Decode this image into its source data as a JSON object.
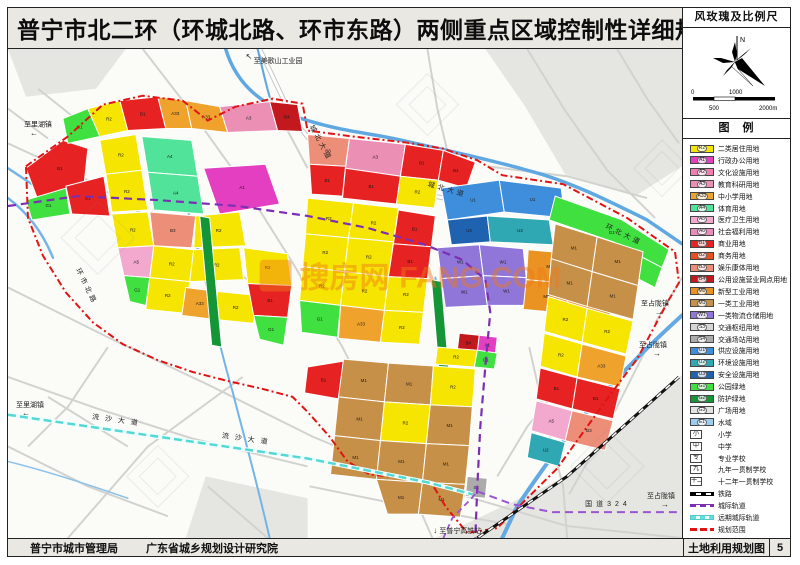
{
  "title": "普宁市北二环（环城北路、环市东路）两侧重点区域控制性详细规划",
  "sidebar": {
    "windrose_title": "风玫瑰及比例尺",
    "north_label": "N",
    "scale": {
      "s0": "0",
      "s500": "500",
      "s1000": "1000",
      "s2000": "2000m"
    },
    "legend_title": "图　例"
  },
  "footer": {
    "agency1": "普宁市城市管理局",
    "agency2": "广东省城乡规划设计研究院",
    "sheet_name": "土地利用规划图",
    "page": "5"
  },
  "watermark": {
    "cn": "搜房网",
    "en": "FANG.COM"
  },
  "legend": {
    "items": [
      {
        "type": "area",
        "code": "R2",
        "label": "二类居住用地",
        "color": "#F5E500"
      },
      {
        "type": "area",
        "code": "A1",
        "label": "行政办公用地",
        "color": "#E33FC0"
      },
      {
        "type": "area",
        "code": "A2",
        "label": "文化设施用地",
        "color": "#F07EB0"
      },
      {
        "type": "area",
        "code": "A3",
        "label": "教育科研用地",
        "color": "#EC8FB4"
      },
      {
        "type": "area",
        "code": "A33",
        "label": "中小学用地",
        "color": "#F0A32C"
      },
      {
        "type": "area",
        "code": "A4",
        "label": "体育用地",
        "color": "#52E39A"
      },
      {
        "type": "area",
        "code": "A5",
        "label": "医疗卫生用地",
        "color": "#F3A8CE"
      },
      {
        "type": "area",
        "code": "A6",
        "label": "社会福利用地",
        "color": "#E98BBB"
      },
      {
        "type": "area",
        "code": "B1",
        "label": "商业用地",
        "color": "#E62222"
      },
      {
        "type": "area",
        "code": "B2",
        "label": "商务用地",
        "color": "#E8501E"
      },
      {
        "type": "area",
        "code": "B3",
        "label": "娱乐康体用地",
        "color": "#EC8E78"
      },
      {
        "type": "area",
        "code": "B4",
        "label": "公用设施营业网点用地",
        "color": "#C2181E"
      },
      {
        "type": "area",
        "code": "M0",
        "label": "新型工业用地",
        "color": "#EA9222"
      },
      {
        "type": "area",
        "code": "M1",
        "label": "一类工业用地",
        "color": "#C79048"
      },
      {
        "type": "area",
        "code": "W1",
        "label": "一类物流仓储用地",
        "color": "#8F76D8"
      },
      {
        "type": "area",
        "code": "S3",
        "label": "交通枢纽用地",
        "color": "#D6D6D6"
      },
      {
        "type": "area",
        "code": "S4",
        "label": "交通场站用地",
        "color": "#ABABAB"
      },
      {
        "type": "area",
        "code": "U1",
        "label": "供应设施用地",
        "color": "#3E8EDC"
      },
      {
        "type": "area",
        "code": "U2",
        "label": "环境设施用地",
        "color": "#2FA8B4"
      },
      {
        "type": "area",
        "code": "U3",
        "label": "安全设施用地",
        "color": "#1F63B0"
      },
      {
        "type": "area",
        "code": "G1",
        "label": "公园绿地",
        "color": "#3FE03F"
      },
      {
        "type": "area",
        "code": "G2",
        "label": "防护绿地",
        "color": "#149637"
      },
      {
        "type": "area",
        "code": "G3",
        "label": "广场用地",
        "color": "#E3E3E3"
      },
      {
        "type": "area",
        "code": "E1",
        "label": "水域",
        "color": "#9CCCF0"
      },
      {
        "type": "symbol",
        "glyph": "小",
        "label": "小学"
      },
      {
        "type": "symbol",
        "glyph": "中",
        "label": "中学"
      },
      {
        "type": "symbol",
        "glyph": "专",
        "label": "专业学校"
      },
      {
        "type": "symbol",
        "glyph": "九",
        "label": "九年一贯制学校"
      },
      {
        "type": "symbol",
        "glyph": "十二",
        "label": "十二年一贯制学校"
      },
      {
        "type": "line",
        "style": "rail",
        "label": "铁路"
      },
      {
        "type": "line",
        "style": "metro",
        "label": "城际轨道"
      },
      {
        "type": "line",
        "style": "future",
        "label": "远期城际轨道"
      },
      {
        "type": "line",
        "style": "bound",
        "label": "规划范围"
      }
    ]
  },
  "map": {
    "labels": [
      {
        "t": "至里湖镇",
        "x": 16,
        "y": 78,
        "fs": 7,
        "arrow": "←",
        "ax": 22,
        "ay": 87
      },
      {
        "t": "至美歌山工业园",
        "x": 246,
        "y": 14,
        "fs": 7,
        "arrow": "↖",
        "ax": 238,
        "ay": 10
      },
      {
        "t": "城北大道",
        "x": 302,
        "y": 78,
        "fs": 7,
        "rot": 62,
        "ls": 3
      },
      {
        "t": "城北大道",
        "x": 420,
        "y": 138,
        "fs": 7,
        "rot": 16,
        "ls": 3
      },
      {
        "t": "环北大道",
        "x": 598,
        "y": 180,
        "fs": 7,
        "rot": 26,
        "ls": 3
      },
      {
        "t": "环市北路",
        "x": 68,
        "y": 222,
        "fs": 7,
        "rot": 64,
        "ls": 3
      },
      {
        "t": "至占陇镇",
        "x": 634,
        "y": 258,
        "fs": 7,
        "arrow": "→",
        "ax": 648,
        "ay": 267
      },
      {
        "t": "至占陇镇",
        "x": 632,
        "y": 300,
        "fs": 7,
        "arrow": "→",
        "ax": 646,
        "ay": 309
      },
      {
        "t": "至里湖镇",
        "x": 8,
        "y": 360,
        "fs": 7,
        "arrow": "←",
        "ax": 14,
        "ay": 369
      },
      {
        "t": "流沙大道",
        "x": 84,
        "y": 372,
        "fs": 7,
        "rot": 8,
        "ls": 6
      },
      {
        "t": "流沙大道",
        "x": 214,
        "y": 391,
        "fs": 7,
        "rot": 8,
        "ls": 6
      },
      {
        "t": "国道324",
        "x": 578,
        "y": 460,
        "fs": 7,
        "ls": 4
      },
      {
        "t": "至占陇镇",
        "x": 640,
        "y": 452,
        "fs": 7,
        "arrow": "→",
        "ax": 654,
        "ay": 461
      },
      {
        "t": "至普宁高铁站",
        "x": 432,
        "y": 487,
        "fs": 7,
        "arrow": "↓",
        "ax": 426,
        "ay": 487
      }
    ],
    "parcels": [
      {
        "c": "B1",
        "p": "18,120 55,92 80,100 76,138 30,152"
      },
      {
        "c": "G1",
        "p": "55,70 80,60 92,88 60,95"
      },
      {
        "c": "R2",
        "p": "80,60 112,52 120,82 92,88"
      },
      {
        "c": "B1",
        "p": "112,52 150,48 158,80 120,82"
      },
      {
        "c": "A33",
        "p": "150,48 178,52 184,80 158,80"
      },
      {
        "c": "G1",
        "p": "18,152 58,140 62,166 24,172"
      },
      {
        "c": "B1",
        "p": "58,138 96,128 102,168 64,166"
      },
      {
        "c": "R2",
        "p": "92,92 128,86 134,122 98,126"
      },
      {
        "c": "R2",
        "p": "98,126 134,122 140,162 104,164"
      },
      {
        "c": "A4",
        "p": "134,88 184,92 190,128 140,124"
      },
      {
        "c": "A4",
        "p": "140,124 190,128 196,166 146,162"
      },
      {
        "c": "A1",
        "p": "196,120 258,116 272,156 212,166"
      },
      {
        "c": "B3",
        "p": "142,164 188,168 184,200 146,198"
      },
      {
        "c": "R2",
        "p": "188,168 232,164 238,198 186,200"
      },
      {
        "c": "A33",
        "p": "178,52 212,58 220,84 184,80"
      },
      {
        "c": "A3",
        "p": "212,58 262,53 270,82 220,84"
      },
      {
        "c": "B4",
        "p": "262,53 290,56 295,83 270,82"
      },
      {
        "c": "R2",
        "p": "104,166 140,164 146,198 110,200"
      },
      {
        "c": "A5",
        "p": "110,200 146,198 142,230 116,228"
      },
      {
        "c": "R2",
        "p": "146,198 186,202 182,234 142,230"
      },
      {
        "c": "R2",
        "p": "186,202 232,200 236,232 182,234"
      },
      {
        "c": "G1",
        "p": "116,228 142,230 138,258 122,254"
      },
      {
        "c": "R2",
        "p": "142,230 182,234 178,266 138,262"
      },
      {
        "c": "A33",
        "p": "178,240 210,244 206,272 174,268"
      },
      {
        "c": "R2",
        "p": "210,244 250,248 246,276 206,272"
      },
      {
        "c": "R2",
        "p": "236,200 280,206 284,238 240,236"
      },
      {
        "c": "B1",
        "p": "240,236 284,238 280,270 246,268"
      },
      {
        "c": "G1",
        "p": "246,268 280,270 276,298 252,292"
      },
      {
        "c": "G2",
        "p": "192,168 202,170 214,300 204,298",
        "nl": 1
      },
      {
        "c": "B3",
        "p": "300,86 342,90 338,118 302,116"
      },
      {
        "c": "B1",
        "p": "302,116 338,118 335,148 304,146"
      },
      {
        "c": "A3",
        "p": "342,90 398,96 393,128 338,120"
      },
      {
        "c": "B1",
        "p": "338,120 393,128 389,156 335,150"
      },
      {
        "c": "B1",
        "p": "398,96 436,102 431,132 393,128"
      },
      {
        "c": "R2",
        "p": "393,128 431,132 427,160 389,156"
      },
      {
        "c": "B1",
        "p": "436,102 468,114 459,140 431,132"
      },
      {
        "c": "U1",
        "p": "434,140 492,132 497,164 440,172"
      },
      {
        "c": "U1",
        "p": "492,132 554,140 558,170 497,164"
      },
      {
        "c": "U3",
        "p": "440,172 480,168 483,194 444,197"
      },
      {
        "c": "U2",
        "p": "480,168 542,172 546,197 483,194"
      },
      {
        "c": "W1",
        "p": "430,200 472,197 476,228 434,231"
      },
      {
        "c": "W1",
        "p": "472,197 516,201 519,230 476,228"
      },
      {
        "c": "W1",
        "p": "434,231 476,228 480,258 438,260"
      },
      {
        "c": "W1",
        "p": "476,228 519,230 522,258 480,258"
      },
      {
        "c": "M0",
        "p": "521,202 566,206 563,236 519,232"
      },
      {
        "c": "M0",
        "p": "566,206 610,213 606,243 563,236"
      },
      {
        "c": "M0",
        "p": "519,232 563,236 559,266 516,262"
      },
      {
        "c": "M0",
        "p": "563,236 606,243 602,273 559,266"
      },
      {
        "c": "R2",
        "p": "300,150 346,155 341,190 298,186"
      },
      {
        "c": "R2",
        "p": "346,155 391,160 386,194 341,190"
      },
      {
        "c": "B1",
        "p": "391,162 428,168 424,199 386,196"
      },
      {
        "c": "R2",
        "p": "298,186 341,190 337,224 295,219"
      },
      {
        "c": "R2",
        "p": "341,190 386,194 381,229 337,224"
      },
      {
        "c": "B1",
        "p": "386,196 424,199 420,231 381,229"
      },
      {
        "c": "R2",
        "p": "295,219 337,224 333,258 292,253"
      },
      {
        "c": "R2",
        "p": "337,224 381,229 377,263 333,258"
      },
      {
        "c": "R2",
        "p": "381,229 420,231 416,265 377,263"
      },
      {
        "c": "A33",
        "p": "333,258 377,263 373,295 331,291"
      },
      {
        "c": "R2",
        "p": "377,263 416,265 412,297 373,295"
      },
      {
        "c": "G1",
        "p": "292,253 333,258 330,290 294,285"
      },
      {
        "c": "G2",
        "p": "424,232 434,234 442,330 432,328",
        "nl": 1
      },
      {
        "c": "B4",
        "p": "452,286 472,288 470,305 450,303"
      },
      {
        "c": "A1",
        "p": "472,288 490,290 488,307 470,305"
      },
      {
        "c": "G1",
        "p": "548,148 615,172 662,202 655,220 606,194 542,172"
      },
      {
        "c": "G1",
        "p": "606,194 655,220 648,240 600,215"
      },
      {
        "c": "M1",
        "p": "548,176 590,189 585,224 544,211"
      },
      {
        "c": "M1",
        "p": "590,189 636,204 631,238 585,224"
      },
      {
        "c": "M1",
        "p": "544,211 585,224 580,259 541,247"
      },
      {
        "c": "M1",
        "p": "585,224 631,238 626,272 580,259"
      },
      {
        "c": "R2",
        "p": "541,249 580,261 575,295 537,284"
      },
      {
        "c": "R2",
        "p": "580,261 626,274 619,307 575,295"
      },
      {
        "c": "R2",
        "p": "537,286 575,297 570,330 533,319"
      },
      {
        "c": "A33",
        "p": "575,297 619,309 613,340 570,330"
      },
      {
        "c": "B1",
        "p": "533,321 570,331 565,362 529,352"
      },
      {
        "c": "B1",
        "p": "570,331 613,342 606,372 565,362"
      },
      {
        "c": "A5",
        "p": "529,354 565,364 558,394 524,384"
      },
      {
        "c": "B3",
        "p": "565,364 606,374 598,404 558,394"
      },
      {
        "c": "U2",
        "p": "524,386 558,396 552,420 520,411"
      },
      {
        "c": "B1",
        "p": "300,320 336,314 331,352 297,346"
      },
      {
        "c": "R2",
        "p": "430,300 470,303 467,320 428,317"
      },
      {
        "c": "G1",
        "p": "470,303 490,306 487,322 467,320"
      },
      {
        "c": "M1",
        "p": "336,312 381,316 377,355 331,350"
      },
      {
        "c": "M1",
        "p": "381,316 426,319 423,358 377,355"
      },
      {
        "c": "R2",
        "p": "426,319 468,322 465,360 423,358"
      },
      {
        "c": "M1",
        "p": "331,350 377,355 373,394 327,389"
      },
      {
        "c": "R2",
        "p": "377,355 423,358 419,397 373,394"
      },
      {
        "c": "M1",
        "p": "423,358 465,360 462,399 419,397"
      },
      {
        "c": "M1",
        "p": "327,389 373,394 369,433 323,428"
      },
      {
        "c": "M1",
        "p": "373,394 419,397 415,436 369,433"
      },
      {
        "c": "M1",
        "p": "419,397 462,399 458,438 415,436"
      },
      {
        "c": "M1",
        "p": "369,433 415,436 411,468 380,468"
      },
      {
        "c": "M1",
        "p": "415,436 458,438 453,471 411,468"
      },
      {
        "c": "S4",
        "p": "460,430 480,432 478,452 458,450"
      }
    ]
  }
}
